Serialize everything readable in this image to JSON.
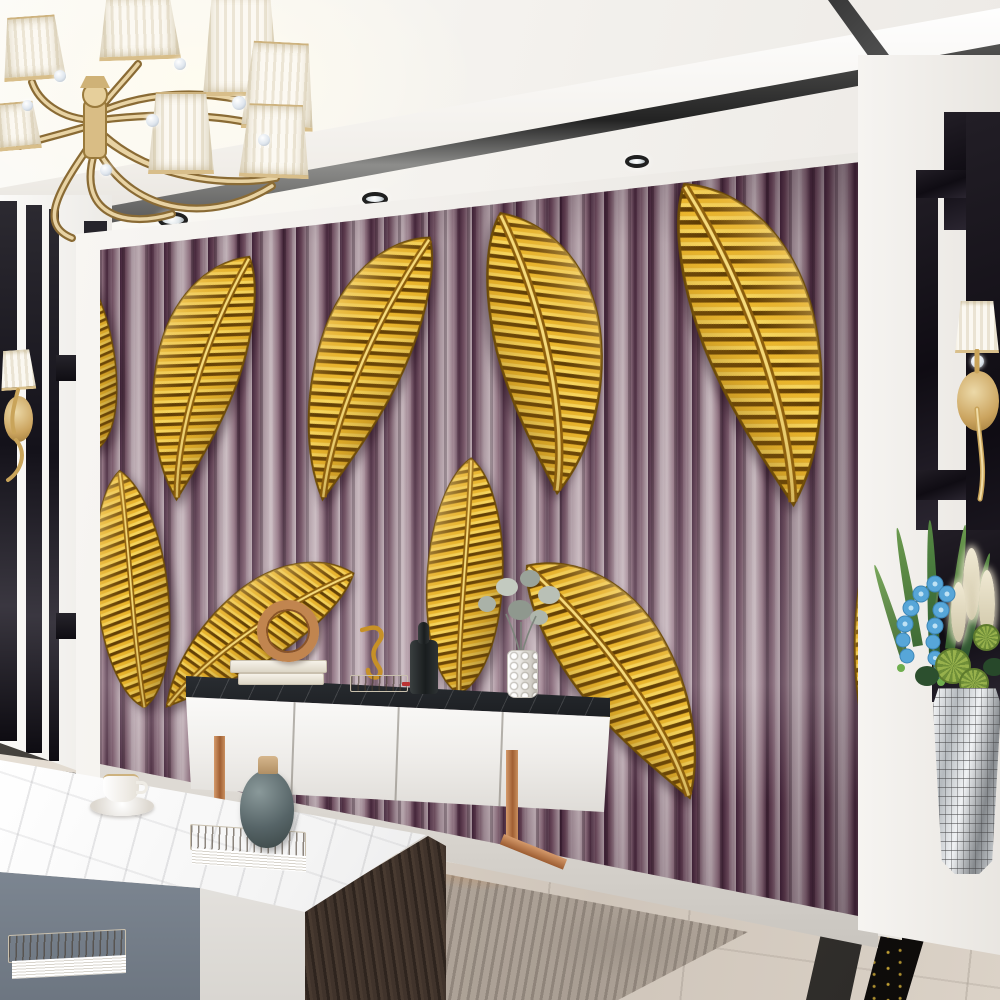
{
  "scene": {
    "title": "Modern living room with golden feather mural on purple striped wallpaper",
    "counts": {
      "mural_feathers": 10,
      "chandelier_shades": 7,
      "ceiling_spotlights": 5,
      "wall_sconces": 2,
      "console_doors": 4
    },
    "palette": {
      "wallpaper_purple_dark": "#44253a",
      "wallpaper_mauve_light": "#c4b4ba",
      "feather_gold": "#d89b1e",
      "feather_gold_light": "#f3cf5a",
      "feather_gold_dark": "#6b4a07",
      "copper_leg": "#b87445",
      "floor_marble": "#d6cdc2",
      "black_marble": "#141217",
      "cabinet_white": "#f2f1ee",
      "rug_orange": "#c06f35",
      "rug_gray": "#aca195",
      "orchid_blue": "#5fa8d3",
      "leaf_green": "#4c7a3f",
      "pampas_cream": "#ece5cf",
      "mosaic_silver": "#c9cdd0",
      "vase_teal_gray": "#566467",
      "ceiling_white": "#f6f4f1"
    },
    "objects": [
      {
        "name": "chandelier",
        "label": "Gold chandelier with white pleated shades and crystals"
      },
      {
        "name": "mural-wall",
        "label": "Feature wall: 3D golden feathers on purple watercolor stripes"
      },
      {
        "name": "tv-console",
        "label": "White TV console with black marble top and copper legs"
      },
      {
        "name": "coffee-table",
        "label": "Marble-top coffee table with gray and white drawers"
      },
      {
        "name": "floor-plant",
        "label": "Arrangement with blue orchids, pampas and cacti in silver mosaic vase"
      },
      {
        "name": "left-sconce",
        "label": "Gold wall sconce with white shade (left wall)"
      },
      {
        "name": "right-sconce",
        "label": "Gold wall sconce with white shade (right wall)"
      },
      {
        "name": "area-rug",
        "label": "Abstract gray and orange rug"
      },
      {
        "name": "ring-sculpture",
        "label": "Copper ring sculpture on books"
      },
      {
        "name": "seahorse-figurine",
        "label": "Gold seahorse figurine"
      },
      {
        "name": "hobnail-vase",
        "label": "White hobnail vase with dried gray flowers"
      },
      {
        "name": "teal-vase",
        "label": "Teal-gray vase with wooden stopper on book"
      },
      {
        "name": "coffee-cup",
        "label": "White coffee cup and saucer"
      },
      {
        "name": "floor-border",
        "label": "Black marble inlay border on beige marble floor"
      }
    ]
  }
}
